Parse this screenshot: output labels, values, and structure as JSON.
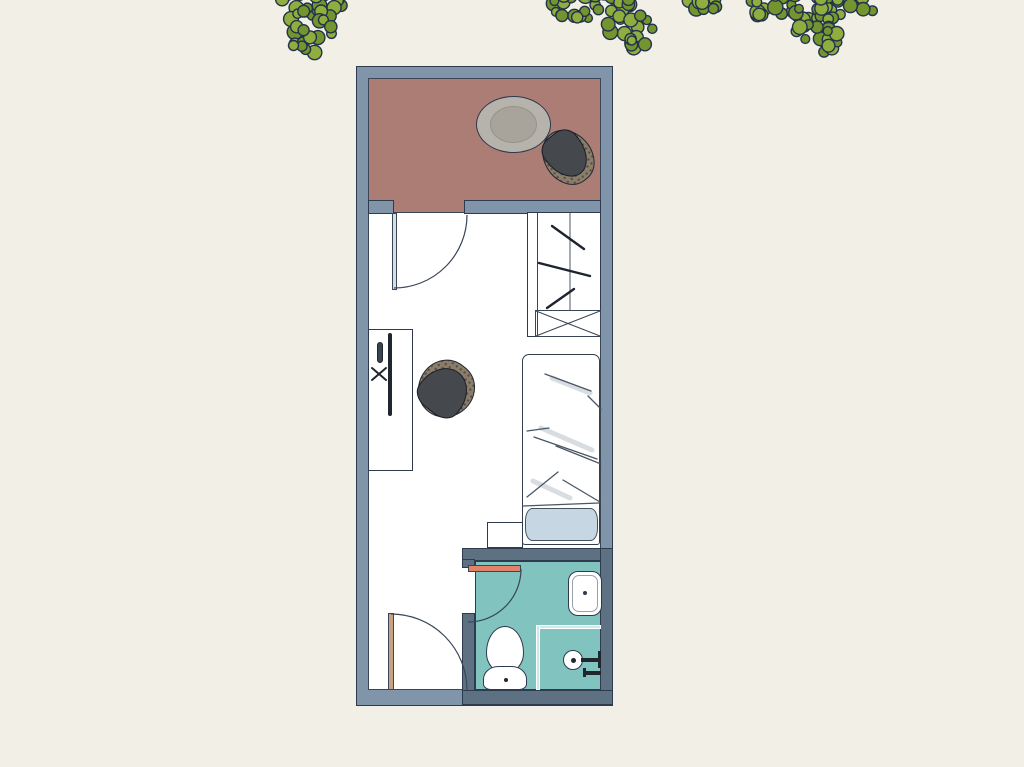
{
  "plan": {
    "name": "studio-apartment-floor-plan",
    "rooms": [
      {
        "name": "balcony"
      },
      {
        "name": "bedroom"
      },
      {
        "name": "bathroom"
      }
    ],
    "furniture": [
      "balcony-table",
      "balcony-chair",
      "balcony-door",
      "wardrobe",
      "desk",
      "wall-mounted-monitor",
      "office-chair",
      "bed",
      "pillow",
      "nightstand",
      "entry-door",
      "bathroom-door",
      "sink",
      "toilet",
      "shower"
    ],
    "decor": [
      "tree-foliage-left",
      "tree-foliage-middle",
      "tree-foliage-right"
    ]
  },
  "colors": {
    "background": "#f1efe6",
    "wall": "#8095a9",
    "wall_dark": "#5e7183",
    "outline": "#2e3a4e",
    "balcony_floor": "#ac7d75",
    "bathroom_floor": "#80c3bf",
    "room_floor": "#ffffff",
    "foliage_green": "#8fae3f",
    "foliage_green_dark": "#74942f",
    "foliage_outline": "#22334a",
    "table_top": "#b6b3ad",
    "table_inner": "#a8a49c",
    "chair_seat": "#45494d",
    "chair_back": "#8b7d69",
    "pillow": "#c6d6e2",
    "door_balcony": "#cfe0e6",
    "door_entry": "#c9a183",
    "door_bathroom": "#e0836a",
    "glass_partition": "#cfe9ea",
    "sketch_line": "#3a4656"
  }
}
